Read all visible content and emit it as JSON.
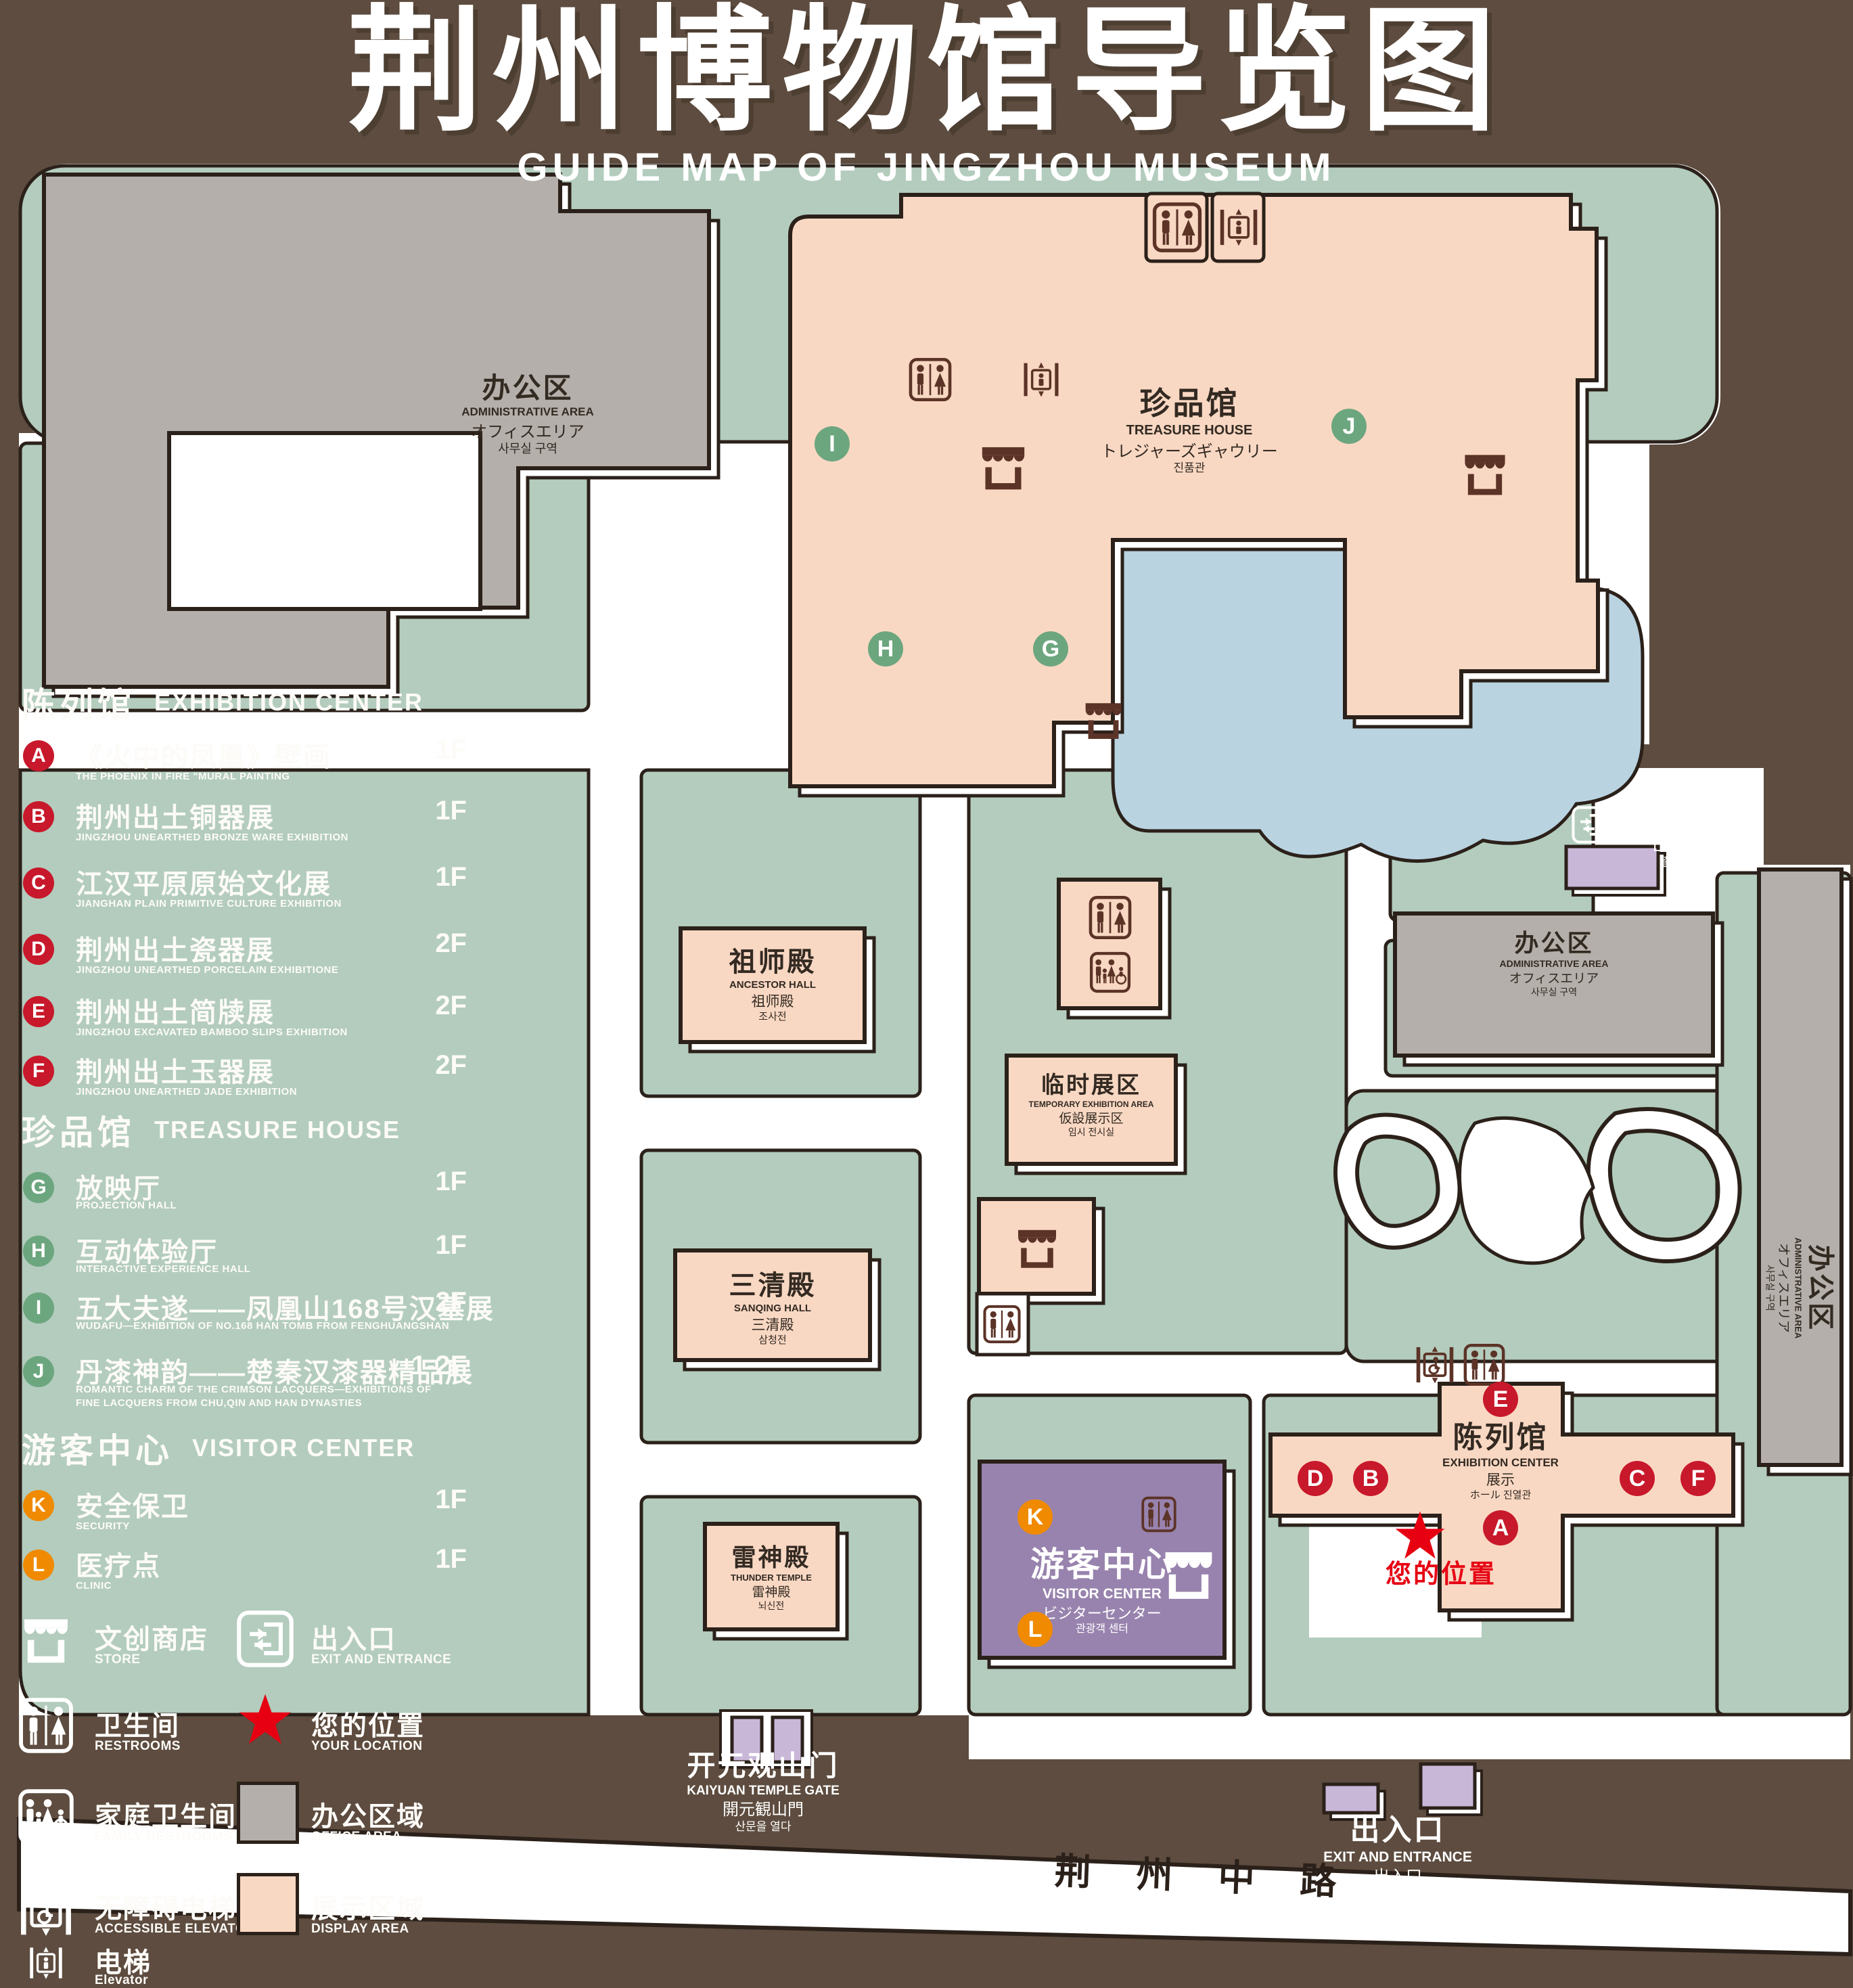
{
  "title": {
    "zh": "荆州博物馆导览图",
    "en": "GUIDE MAP OF JINGZHOU MUSEUM"
  },
  "colors": {
    "background": "#5D4C3F",
    "lawn": "#B3CCBD",
    "office": "#B4AFAA",
    "display_area": "#F9D8C3",
    "pond": "#B9D3E1",
    "visitor_center": "#9883AE",
    "small_building": "#C9B7D8",
    "badge_red": "#C8182B",
    "badge_green": "#6CA67F",
    "badge_orange": "#F08A00",
    "location_red": "#E60012",
    "icon_maroon": "#5C3327"
  },
  "legend": {
    "sections": [
      {
        "id": "exhibition",
        "zh": "陈列馆",
        "en": "EXHIBITION CENTER",
        "items": [
          {
            "letter": "A",
            "zh": "《火中的凤凰》壁画",
            "en": "THE PHOENIX IN FIRE \"MURAL PAINTING",
            "floor": "1F"
          },
          {
            "letter": "B",
            "zh": "荆州出土铜器展",
            "en": "JINGZHOU UNEARTHED BRONZE WARE EXHIBITION",
            "floor": "1F"
          },
          {
            "letter": "C",
            "zh": "江汉平原原始文化展",
            "en": "JIANGHAN PLAIN PRIMITIVE CULTURE EXHIBITION",
            "floor": "1F"
          },
          {
            "letter": "D",
            "zh": "荆州出土瓷器展",
            "en": "JINGZHOU UNEARTHED PORCELAIN EXHIBITIONE",
            "floor": "2F"
          },
          {
            "letter": "E",
            "zh": "荆州出土简牍展",
            "en": "JINGZHOU EXCAVATED BAMBOO SLIPS EXHIBITION",
            "floor": "2F"
          },
          {
            "letter": "F",
            "zh": "荆州出土玉器展",
            "en": "JINGZHOU UNEARTHED JADE EXHIBITION",
            "floor": "2F"
          }
        ]
      },
      {
        "id": "treasure",
        "zh": "珍品馆",
        "en": "TREASURE HOUSE",
        "items": [
          {
            "letter": "G",
            "zh": "放映厅",
            "en": "PROJECTION HALL",
            "floor": "1F"
          },
          {
            "letter": "H",
            "zh": "互动体验厅",
            "en": "INTERACTIVE EXPERIENCE HALL",
            "floor": "1F"
          },
          {
            "letter": "I",
            "zh": "五大夫遂——凤凰山168号汉墓展",
            "en": "WUDAFU—EXHIBITION OF NO.168 HAN TOMB FROM FENGHUANGSHAN",
            "floor": "2F"
          },
          {
            "letter": "J",
            "zh": "丹漆神韵——楚秦汉漆器精品展",
            "en": "ROMANTIC CHARM OF THE CRIMSON LACQUERS—EXHIBITIONS OF FINE LACQUERS FROM CHU,QIN AND HAN DYNASTIES",
            "floor": "1-2F"
          }
        ]
      },
      {
        "id": "visitor",
        "zh": "游客中心",
        "en": "VISITOR CENTER",
        "items": [
          {
            "letter": "K",
            "zh": "安全保卫",
            "en": "SECURITY",
            "floor": "1F"
          },
          {
            "letter": "L",
            "zh": "医疗点",
            "en": "CLINIC",
            "floor": "1F"
          }
        ]
      }
    ],
    "symbols": {
      "store": {
        "zh": "文创商店",
        "en": "STORE"
      },
      "exit": {
        "zh": "出入口",
        "en": "EXIT AND ENTRANCE"
      },
      "restroom": {
        "zh": "卫生间",
        "en": "RESTROOMS"
      },
      "location": {
        "zh": "您的位置",
        "en": "YOUR LOCATION"
      },
      "family": {
        "zh": "家庭卫生间",
        "en": "FAMILY RESTROOMS"
      },
      "office": {
        "zh": "办公区域",
        "en": "OFFICE AREA",
        "color": "#B4AFAA"
      },
      "accessible": {
        "zh": "无障碍电梯",
        "en": "ACCESSIBLE ELEVATOR"
      },
      "display": {
        "zh": "展示区域",
        "en": "DISPLAY AREA",
        "color": "#F9D8C3"
      },
      "elevator": {
        "zh": "电梯",
        "en": "Elevator"
      }
    }
  },
  "map": {
    "buildings": {
      "admin_nw": {
        "zh": "办公区",
        "en": "ADMINISTRATIVE AREA",
        "ja": "オフィスエリア",
        "ko": "사무실 구역"
      },
      "treasure_house": {
        "zh": "珍品馆",
        "en": "TREASURE HOUSE",
        "ja": "トレジャーズギャウリー",
        "ko": "진품관"
      },
      "ancestor_hall": {
        "zh": "祖师殿",
        "en": "ANCESTOR HALL",
        "ja": "祖师殿",
        "ko": "조사전"
      },
      "temporary_exhibition": {
        "zh": "临时展区",
        "en": "TEMPORARY EXHIBITION AREA",
        "ja": "仮設展示区",
        "ko": "임시 전시실"
      },
      "sanqing_hall": {
        "zh": "三清殿",
        "en": "SANQING HALL",
        "ja": "三清殿",
        "ko": "삼청전"
      },
      "thunder_temple": {
        "zh": "雷神殿",
        "en": "THUNDER TEMPLE",
        "ja": "雷神殿",
        "ko": "뇌신전"
      },
      "visitor_center": {
        "zh": "游客中心",
        "en": "VISITOR CENTER",
        "ja": "ビジターセンター",
        "ko": "관광객 센터"
      },
      "exhibition_center": {
        "zh": "陈列馆",
        "en": "EXHIBITION CENTER",
        "ja": "展示",
        "ko": "ホール 진열관"
      },
      "admin_mid": {
        "zh": "办公区",
        "en": "ADMINISTRATIVE AREA",
        "ja": "オフィスエリア",
        "ko": "사무실 구역"
      },
      "admin_east": {
        "zh": "办公区",
        "en": "ADMINISTRATIVE AREA",
        "ja": "オフィスエリア",
        "ko": "사무실 구역"
      }
    },
    "exits": {
      "northeast": {
        "zh": "出入口",
        "en": "EXIT AND ENTRANCE",
        "ja": "出入口",
        "ko": "출입구"
      },
      "south": {
        "zh": "出入口",
        "en": "EXIT AND ENTRANCE",
        "ja": "出入口",
        "ko": "출입구"
      }
    },
    "gate": {
      "zh": "开元观山门",
      "en": "KAIYUAN TEMPLE GATE",
      "ja": "開元観山門",
      "ko": "산문을 열다"
    },
    "road": "荆 州 中 路",
    "your_location": "您的位置",
    "badges": {
      "A": "A",
      "B": "B",
      "C": "C",
      "D": "D",
      "E": "E",
      "F": "F",
      "G": "G",
      "H": "H",
      "I": "I",
      "J": "J",
      "K": "K",
      "L": "L"
    }
  }
}
